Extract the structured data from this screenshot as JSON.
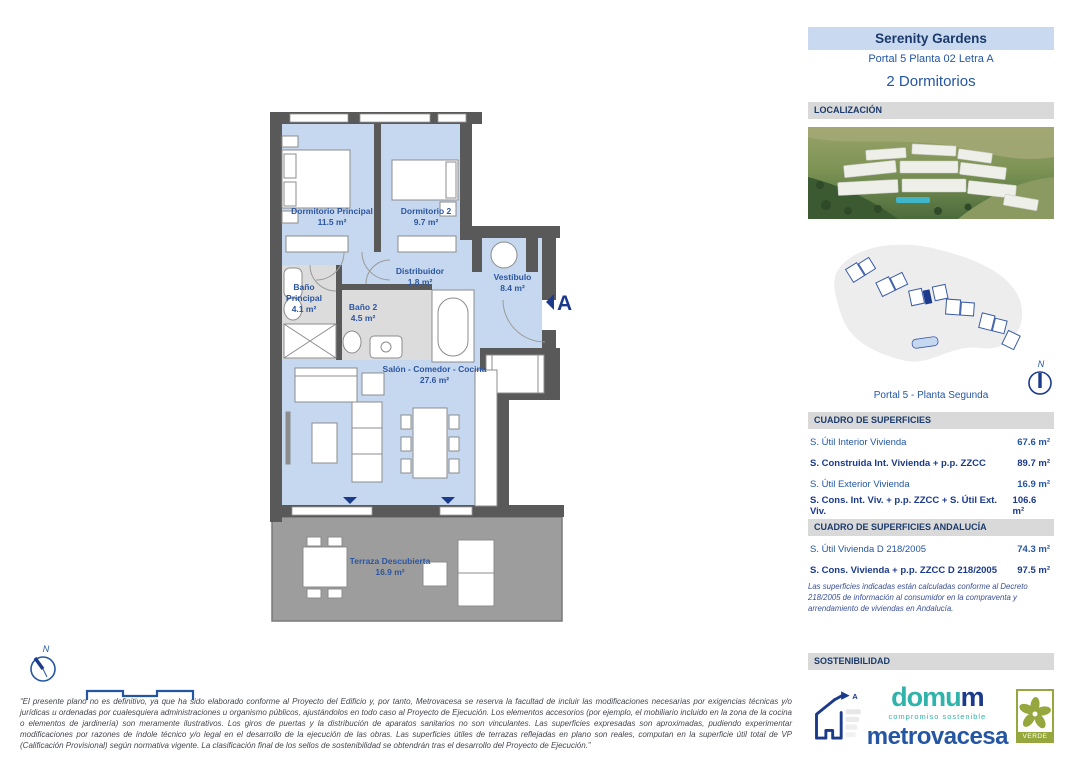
{
  "header": {
    "project": "Serenity Gardens",
    "unit": "Portal 5 Planta 02 Letra A",
    "bedrooms": "2 Dormitorios"
  },
  "plan": {
    "rooms": [
      {
        "name": "Dormitorio Principal",
        "area": "11.5 m²"
      },
      {
        "name": "Dormitorio 2",
        "area": "9.7 m²"
      },
      {
        "name": "Baño Principal",
        "area": "4.1 m²"
      },
      {
        "name": "Baño 2",
        "area": "4.5 m²"
      },
      {
        "name": "Distribuidor",
        "area": "1.8 m²"
      },
      {
        "name": "Vestíbulo",
        "area": "8.4 m²"
      },
      {
        "name": "Salón - Comedor - Cocina",
        "area": "27.6 m²"
      },
      {
        "name": "Terraza Descubierta",
        "area": "16.9 m²"
      }
    ],
    "entrance_label": "A",
    "compass_label": "N"
  },
  "localizacion": {
    "title": "LOCALIZACIÓN",
    "siteplan_caption": "Portal 5 - Planta Segunda",
    "compass_label": "N"
  },
  "superficies": {
    "title": "CUADRO DE SUPERFICIES",
    "rows": [
      {
        "label": "S. Útil Interior Vivienda",
        "value": "67.6 m²"
      },
      {
        "label": "S. Construida Int. Vivienda + p.p. ZZCC",
        "value": "89.7 m²"
      },
      {
        "label": "S. Útil Exterior Vivienda",
        "value": "16.9 m²"
      },
      {
        "label": "S. Cons. Int. Viv. + p.p. ZZCC + S. Útil Ext. Viv.",
        "value": "106.6 m²"
      }
    ]
  },
  "andalucia": {
    "title": "CUADRO DE SUPERFICIES ANDALUCÍA",
    "rows": [
      {
        "label": "S. Útil Vivienda D 218/2005",
        "value": "74.3 m²"
      },
      {
        "label": "S. Cons. Vivienda + p.p. ZZCC D 218/2005",
        "value": "97.5 m²"
      }
    ],
    "note": "Las superficies indicadas están calculadas conforme al Decreto 218/2005 de información al consumidor en la compraventa y arrendamiento de viviendas en Andalucía."
  },
  "sustainability": {
    "title": "SOSTENIBILIDAD",
    "energy_rating": "A",
    "brand_prefix": "domu",
    "brand_suffix": "m",
    "brand_tagline": "compromiso sostenible",
    "brand_main": "metrovacesa",
    "cert_label": "VERDE"
  },
  "disclaimer": "“El presente plano no es definitivo, ya que ha sido elaborado conforme al Proyecto del Edificio y, por tanto, Metrovacesa se reserva la facultad de incluir las modificaciones necesarias por exigencias técnicas y/o jurídicas u ordenadas por cualesquiera administraciones u organismo públicos, ajustándolos en todo caso al Proyecto de Ejecución. Los elementos accesorios (por ejemplo, el mobiliario incluido en la zona de la cocina o elementos de jardinería) son meramente ilustrativos. Los giros de puertas y la distribución de aparatos sanitarios no son vinculantes. Las superficies expresadas son aproximadas, pudiendo experimentar modificaciones por razones de índole técnico y/o legal en el desarrollo de la ejecución de las obras. Las superficies útiles de terrazas reflejadas en plano son reales, computan en la superficie útil total de VP (Calificación Provisional) según normativa vigente. La clasificación final de los sellos de sostenibilidad se obtendrán tras el desarrollo del Proyecto de Ejecución.”",
  "colors": {
    "accent_navy": "#1b3a6b",
    "accent_blue": "#2456a4",
    "band_gray": "#d9d9d9",
    "header_band": "#c9daf0",
    "wall": "#595959",
    "room_blue": "#c5d8ef",
    "bath_gray": "#dcdcdc",
    "terrace_gray": "#9d9d9d",
    "domum_teal": "#2fb3aa",
    "verde_green": "#96a83d"
  }
}
